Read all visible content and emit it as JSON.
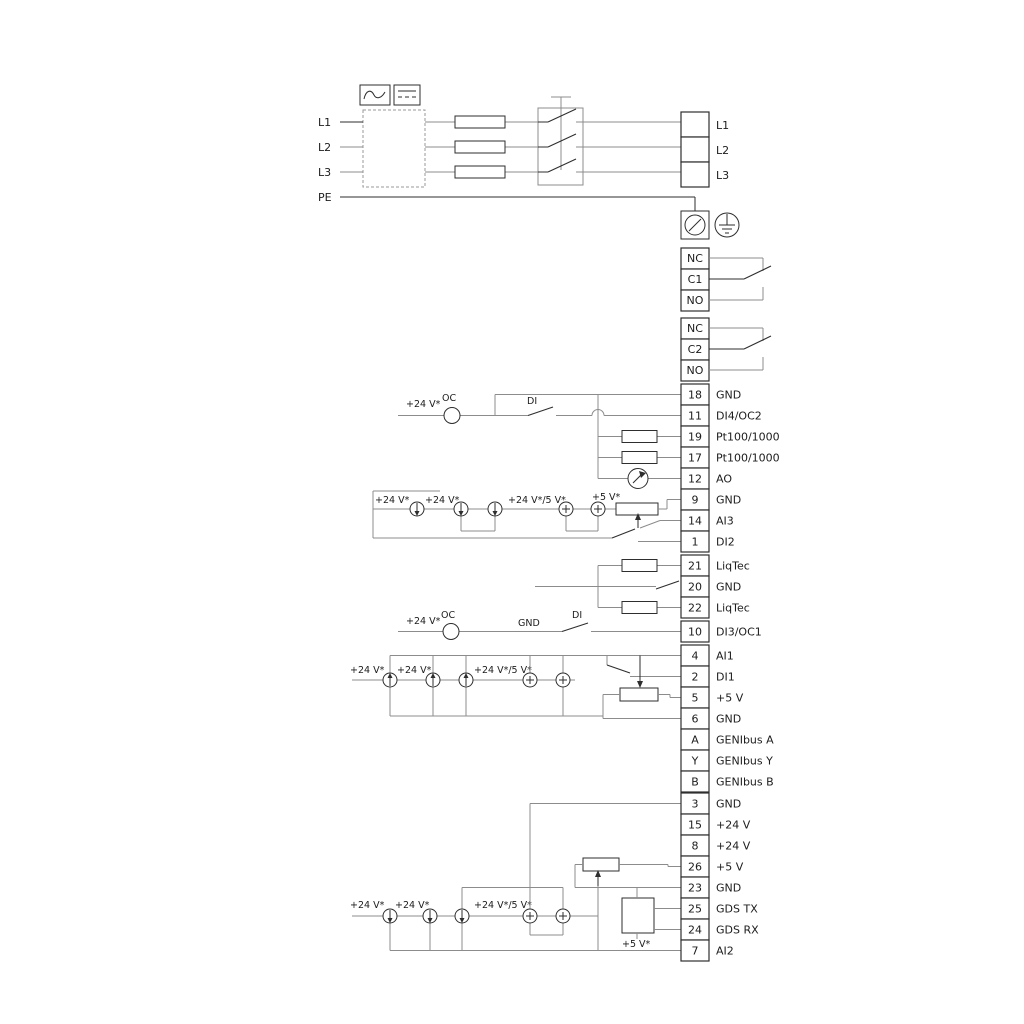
{
  "power": {
    "inputs": [
      "L1",
      "L2",
      "L3",
      "PE"
    ],
    "outputs": [
      "L1",
      "L2",
      "L3"
    ]
  },
  "relays": {
    "r1": [
      "NC",
      "C1",
      "NO"
    ],
    "r2": [
      "NC",
      "C2",
      "NO"
    ]
  },
  "io1": [
    {
      "id": "18",
      "label": "GND"
    },
    {
      "id": "11",
      "label": "DI4/OC2"
    },
    {
      "id": "19",
      "label": "Pt100/1000"
    },
    {
      "id": "17",
      "label": "Pt100/1000"
    },
    {
      "id": "12",
      "label": "AO"
    },
    {
      "id": "9",
      "label": "GND"
    },
    {
      "id": "14",
      "label": "AI3"
    },
    {
      "id": "1",
      "label": "DI2"
    }
  ],
  "liqtec": [
    {
      "id": "21",
      "label": "LiqTec"
    },
    {
      "id": "20",
      "label": "GND"
    },
    {
      "id": "22",
      "label": "LiqTec"
    }
  ],
  "io2": [
    {
      "id": "10",
      "label": "DI3/OC1"
    },
    {
      "id": "4",
      "label": "AI1"
    },
    {
      "id": "2",
      "label": "DI1"
    },
    {
      "id": "5",
      "label": "+5 V"
    },
    {
      "id": "6",
      "label": "GND"
    },
    {
      "id": "A",
      "label": "GENIbus A"
    },
    {
      "id": "Y",
      "label": "GENIbus Y"
    },
    {
      "id": "B",
      "label": "GENIbus B"
    }
  ],
  "io3": [
    {
      "id": "3",
      "label": "GND"
    },
    {
      "id": "15",
      "label": "+24 V"
    },
    {
      "id": "8",
      "label": "+24 V"
    },
    {
      "id": "26",
      "label": "+5 V"
    },
    {
      "id": "23",
      "label": "GND"
    },
    {
      "id": "25",
      "label": "GDS TX"
    },
    {
      "id": "24",
      "label": "GDS RX"
    },
    {
      "id": "7",
      "label": "AI2"
    }
  ],
  "sym": {
    "v24": "+24 V*",
    "v24_5": "+24 V*/5 V*",
    "v5": "+5 V*",
    "oc": "OC",
    "di": "DI",
    "gnd": "GND"
  },
  "colors": {
    "wire": "#8c8c8c",
    "dark": "#2e2e2e",
    "text": "#1c1c1c"
  }
}
